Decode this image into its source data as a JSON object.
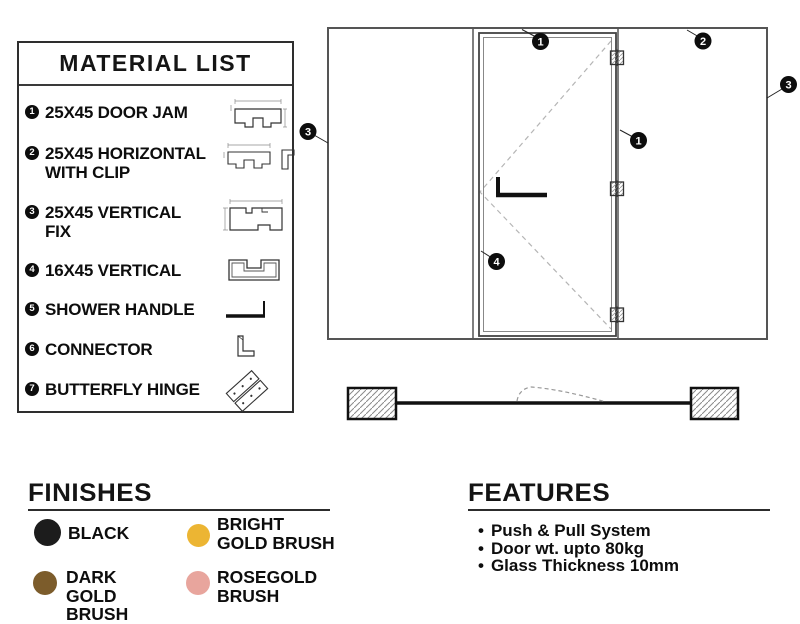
{
  "material_list": {
    "title": "MATERIAL LIST",
    "items": [
      {
        "num": "1",
        "label": "25X45 DOOR JAM"
      },
      {
        "num": "2",
        "label": "25X45 HORIZONTAL WITH CLIP"
      },
      {
        "num": "3",
        "label": "25X45 VERTICAL FIX"
      },
      {
        "num": "4",
        "label": "16X45 VERTICAL"
      },
      {
        "num": "5",
        "label": "SHOWER HANDLE"
      },
      {
        "num": "6",
        "label": "CONNECTOR"
      },
      {
        "num": "7",
        "label": "BUTTERFLY HINGE"
      }
    ]
  },
  "diagram": {
    "callouts": [
      "1",
      "2",
      "3",
      "3",
      "1",
      "4"
    ]
  },
  "finishes": {
    "title": "FINISHES",
    "swatches": [
      {
        "label": "BLACK",
        "color": "#1c1c1c"
      },
      {
        "label": "BRIGHT GOLD BRUSH",
        "color": "#ecb533"
      },
      {
        "label": "DARK GOLD BRUSH",
        "color": "#7c5c2b"
      },
      {
        "label": "ROSEGOLD BRUSH",
        "color": "#e8a59d"
      }
    ]
  },
  "features": {
    "title": "FEATURES",
    "items": [
      "Push & Pull System",
      "Door wt. upto 80kg",
      "Glass Thickness 10mm"
    ]
  }
}
